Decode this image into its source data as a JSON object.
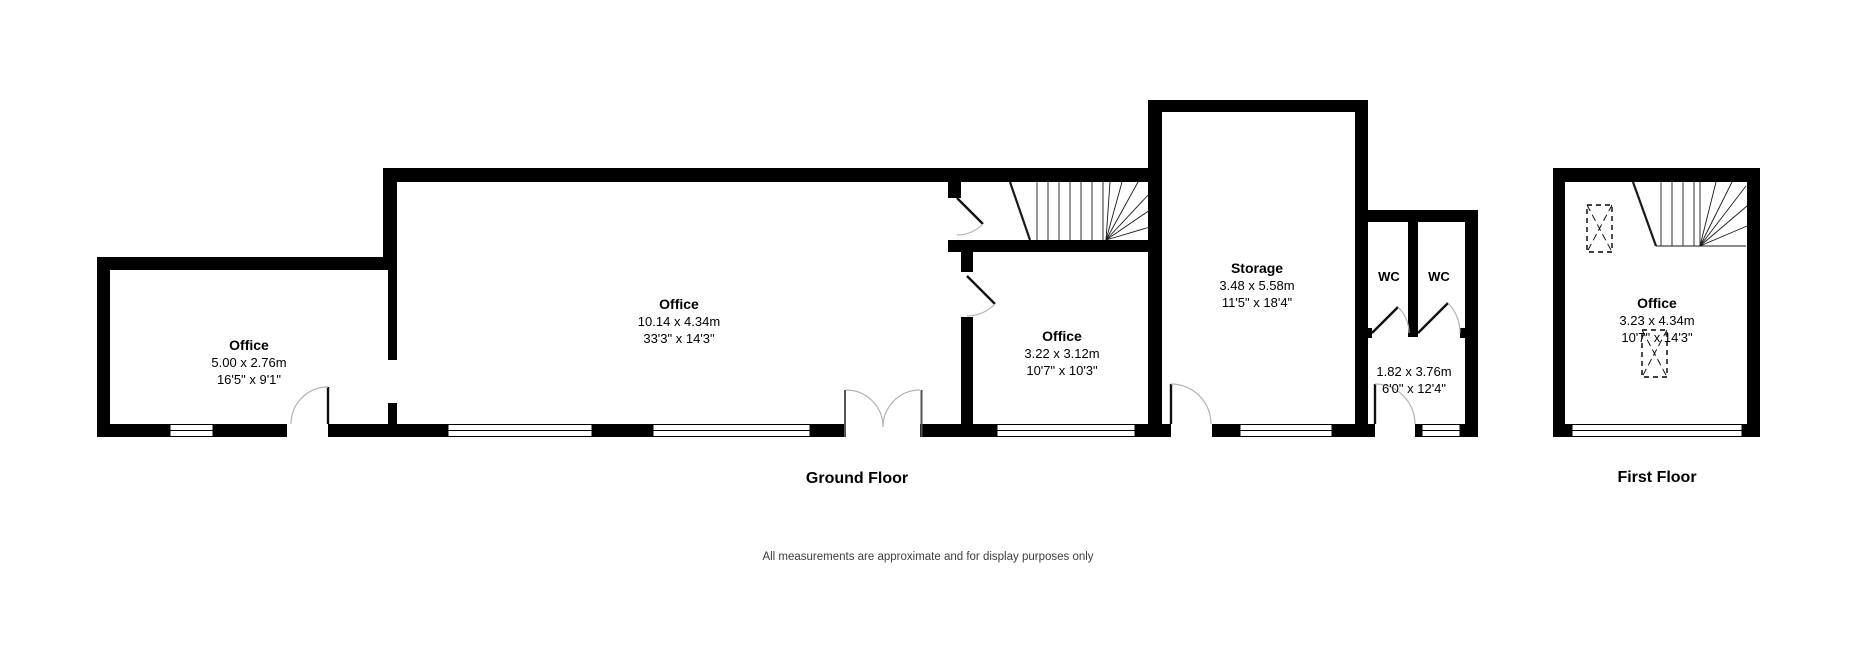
{
  "floors": {
    "ground": {
      "label": "Ground Floor",
      "rooms": {
        "office_left": {
          "name": "Office",
          "metric": "5.00 x 2.76m",
          "imperial": "16'5\" x 9'1\""
        },
        "office_main": {
          "name": "Office",
          "metric": "10.14 x 4.34m",
          "imperial": "33'3\" x 14'3\""
        },
        "office_small": {
          "name": "Office",
          "metric": "3.22 x 3.12m",
          "imperial": "10'7\" x 10'3\""
        },
        "storage": {
          "name": "Storage",
          "metric": "3.48 x 5.58m",
          "imperial": "11'5\" x 18'4\""
        },
        "wc_left": {
          "name": "WC"
        },
        "wc_right": {
          "name": "WC"
        },
        "lobby": {
          "metric": "1.82 x 3.76m",
          "imperial": "6'0\" x 12'4\""
        }
      }
    },
    "first": {
      "label": "First Floor",
      "rooms": {
        "office": {
          "name": "Office",
          "metric": "3.23 x 4.34m",
          "imperial": "10'7\" x 14'3\""
        }
      }
    }
  },
  "disclaimer": "All measurements are approximate and for display purposes only",
  "colors": {
    "wall": "#000000",
    "door_leaf": "#111111",
    "door_arc": "#b3b3b3",
    "stair_line": "#1a1a1a",
    "text": "#000000",
    "disclaimer_text": "#3d3d3d"
  }
}
